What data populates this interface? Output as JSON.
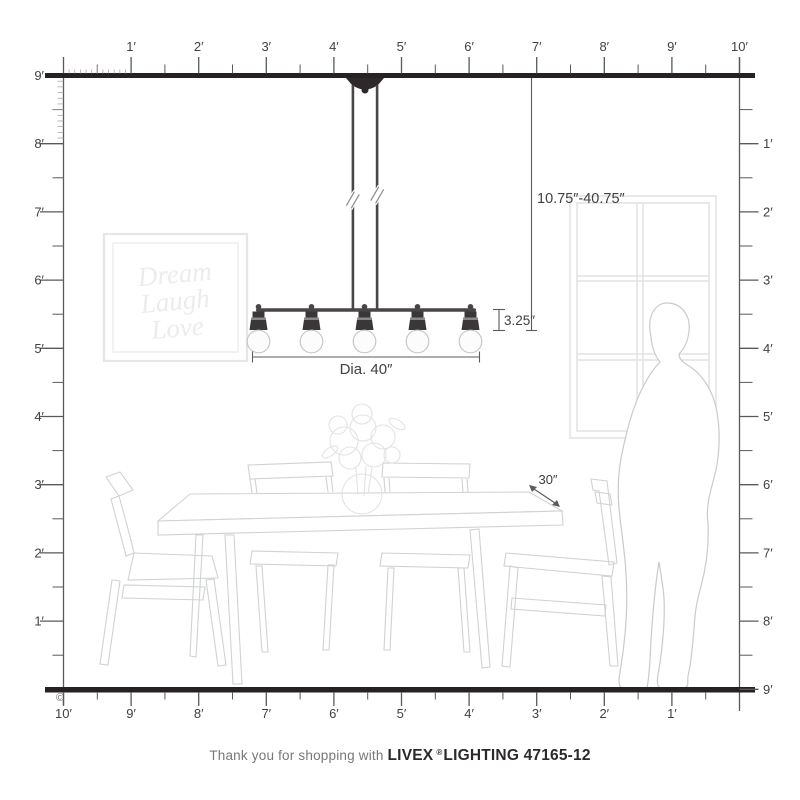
{
  "rulers": {
    "top": [
      "1′",
      "2′",
      "3′",
      "4′",
      "5′",
      "6′",
      "7′",
      "8′",
      "9′",
      "10′"
    ],
    "bottom": [
      "10′",
      "9′",
      "8′",
      "7′",
      "6′",
      "5′",
      "4′",
      "3′",
      "2′",
      "1′"
    ],
    "left": [
      "9′",
      "8′",
      "7′",
      "6′",
      "5′",
      "4′",
      "3′",
      "2′",
      "1′"
    ],
    "right": [
      "1′",
      "2′",
      "3′",
      "4′",
      "5′",
      "6′",
      "7′",
      "8′",
      "9′"
    ]
  },
  "annotations": {
    "hang_range": "10.75″-40.75″",
    "fixture_height": "3.25″",
    "diameter": "Dia. 40″",
    "table_dim": "30″",
    "copyright": "©"
  },
  "wall_art": {
    "lines": [
      "Dream",
      "Laugh",
      "Love"
    ]
  },
  "fixture": {
    "bulbs": 5
  },
  "footer": {
    "prefix": "Thank you for shopping with",
    "brand": "LIVEX",
    "registered": "®",
    "model": "LIGHTING 47165-12"
  },
  "colors": {
    "structure_dark": "#262122",
    "ruler": "#58595b",
    "label_text": "#414042",
    "fixture_metal": "#4a4546",
    "furniture_line": "#d0d2d3",
    "window_line": "#e1e2e3",
    "art_text": "#ebecec"
  }
}
